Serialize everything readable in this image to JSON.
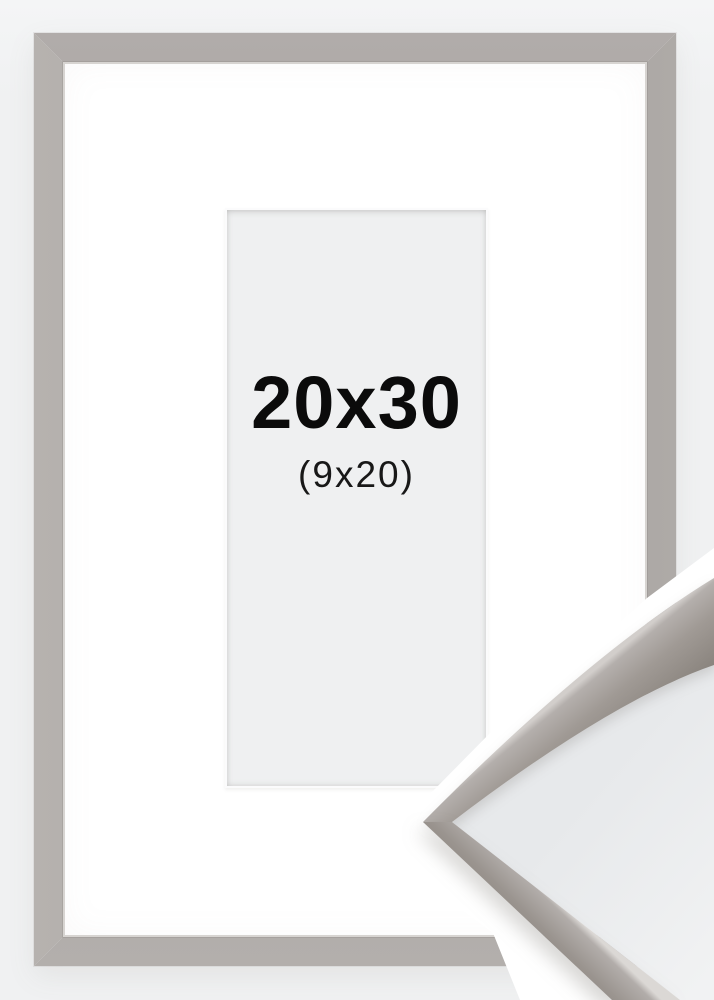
{
  "frame_label": {
    "size": "20x30",
    "inner_size": "(9x20)"
  },
  "colors": {
    "background": "#f0f1f2",
    "mat": "#ffffff",
    "aperture": "#eff0f1",
    "frame_taupe": "#a39d99",
    "frame_highlight": "#d7d4d1",
    "label_text": "#0b0b0b"
  }
}
